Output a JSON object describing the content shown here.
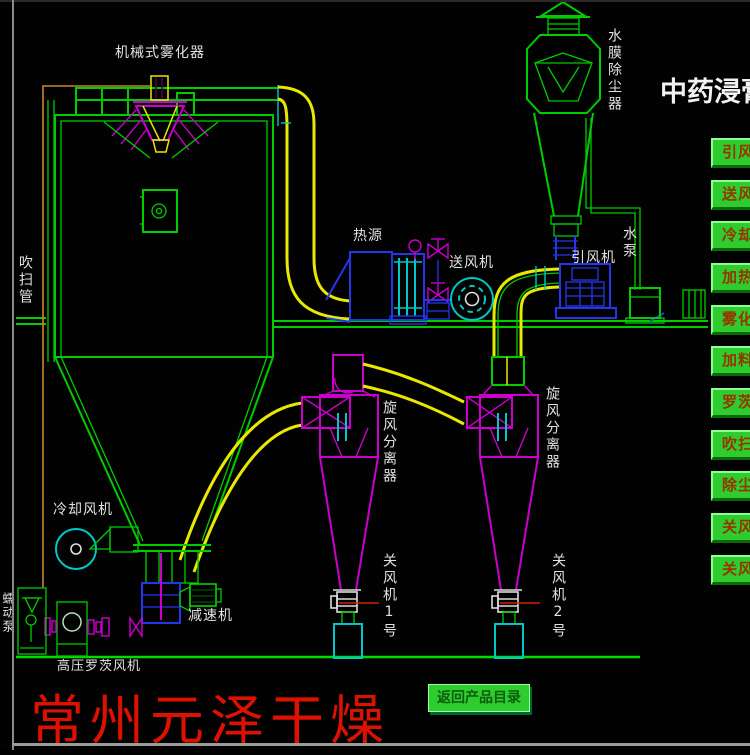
{
  "header": {
    "title": "中药浸膏"
  },
  "diagram": {
    "labels": {
      "atomizer": "机械式雾化器",
      "dust_collector": "水膜除尘器",
      "purge_pipe": "吹扫管",
      "heat_source": "热源",
      "supply_fan": "送风机",
      "induced_draft_fan": "引风机",
      "water_pump": "水泵",
      "cyclone_1": "旋风分离器",
      "cyclone_2": "旋风分离器",
      "cooling_fan": "冷却风机",
      "gear_reducer": "减速机",
      "rotary_valve_1": "关风机1号",
      "rotary_valve_2": "关风机2号",
      "peristaltic_pump": "蠕动泵",
      "roots_blower": "高压罗茨风机"
    }
  },
  "control_panel": {
    "buttons": [
      {
        "label": "引风"
      },
      {
        "label": "送风"
      },
      {
        "label": "冷却"
      },
      {
        "label": "加热"
      },
      {
        "label": "雾化"
      },
      {
        "label": "加料"
      },
      {
        "label": "罗茨"
      },
      {
        "label": "吹扫"
      },
      {
        "label": "除尘"
      },
      {
        "label": "关风"
      },
      {
        "label": "关风"
      }
    ]
  },
  "footer": {
    "brand": "常州元泽干燥",
    "back_button": "返回产品目录"
  },
  "colors": {
    "background": "#000000",
    "line_green": "#00cc00",
    "line_magenta": "#cc00cc",
    "line_yellow": "#e8e800",
    "line_cyan": "#00c8c8",
    "line_blue": "#2336ee",
    "line_orange": "#c8882a",
    "label_white": "#e2e2e2",
    "brand_red": "#dd1100",
    "button_green": "#2ecc2e",
    "button_text": "#983300"
  }
}
